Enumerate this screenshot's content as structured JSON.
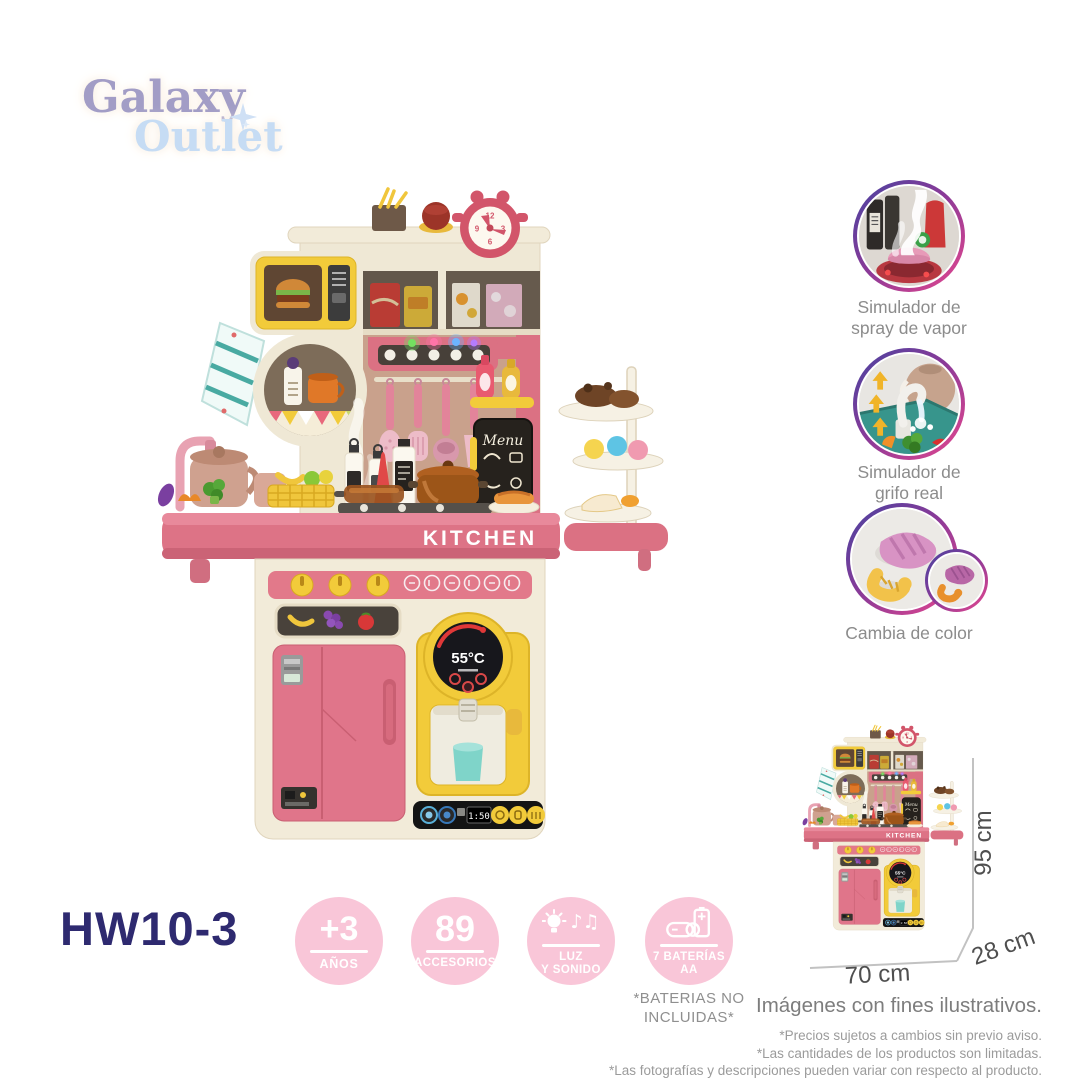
{
  "logo": {
    "word1": "Galaxy",
    "word2": "Outlet"
  },
  "features": [
    {
      "lines": [
        "Simulador de",
        "spray de vapor"
      ]
    },
    {
      "lines": [
        "Simulador de",
        "grifo real"
      ]
    },
    {
      "lines": [
        "Cambia de color"
      ]
    }
  ],
  "dimensions": {
    "height": "95 cm",
    "width": "70 cm",
    "depth": "28 cm"
  },
  "product_code": "HW10-3",
  "badges": [
    {
      "value": "+3",
      "label1": "AÑOS"
    },
    {
      "value": "89",
      "label1": "ACCESORIOS"
    },
    {
      "icon": "light-music",
      "label1": "LUZ",
      "label2": "Y SONIDO"
    },
    {
      "icon": "battery",
      "label1": "7 BATERÍAS",
      "label2": "AA"
    }
  ],
  "battery_note": {
    "line1": "*BATERIAS NO",
    "line2": "INCLUIDAS*"
  },
  "disclaimer": {
    "title": "Imágenes con fines ilustrativos.",
    "note1": "*Precios sujetos a cambios sin previo aviso.",
    "note2": "*Las cantidades de los productos son limitadas.",
    "note3": "*Las fotografías y descripciones pueden variar  con respecto al producto."
  },
  "kitchen": {
    "brand": "KITCHEN",
    "temperature": "55°C",
    "menu_sign": "Menu",
    "timer": "1:50",
    "clock": {
      "n12": "12",
      "n3": "3",
      "n6": "6",
      "n9": "9"
    }
  },
  "colors": {
    "accent_pink": "#dd7386",
    "raspberry": "#d2556a",
    "cream": "#f2ebd9",
    "yellow": "#f2cb3a",
    "badge_pink": "#f9c6d8",
    "navy": "#2e2a70",
    "ring_gradient_start": "#4743a0",
    "ring_gradient_end": "#e8478e",
    "teal_cup": "#7fd4c9",
    "logo_purple": "#a29dc6",
    "logo_blue": "#c6dcf4"
  }
}
